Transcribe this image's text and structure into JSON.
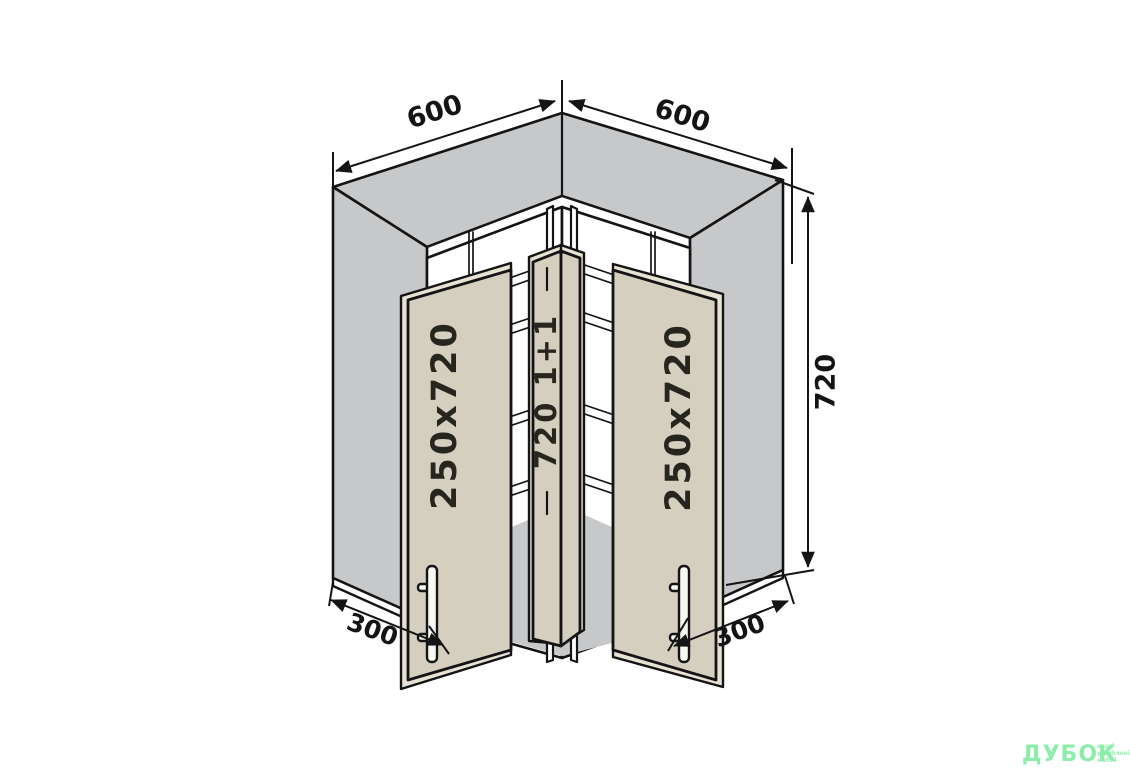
{
  "dimensions": {
    "width_left": "600",
    "width_right": "600",
    "height": "720",
    "depth_left": "300",
    "depth_right": "300"
  },
  "labels": {
    "left_door": "250x720",
    "right_door": "250x720",
    "corner_door": "720 1+1"
  },
  "watermark": {
    "brand": "ДУБОК",
    "tagline_lines": [
      "ваші",
      "улюблені",
      "меблі"
    ]
  },
  "colors": {
    "background": "#ffffff",
    "panel_gray": "#c7c8ca",
    "door_beige": "#d5cfbf",
    "door_edge_beige": "#e7e2d4",
    "outline": "#141414",
    "dimension_text": "#141414",
    "watermark_green": "#8dedaa"
  }
}
